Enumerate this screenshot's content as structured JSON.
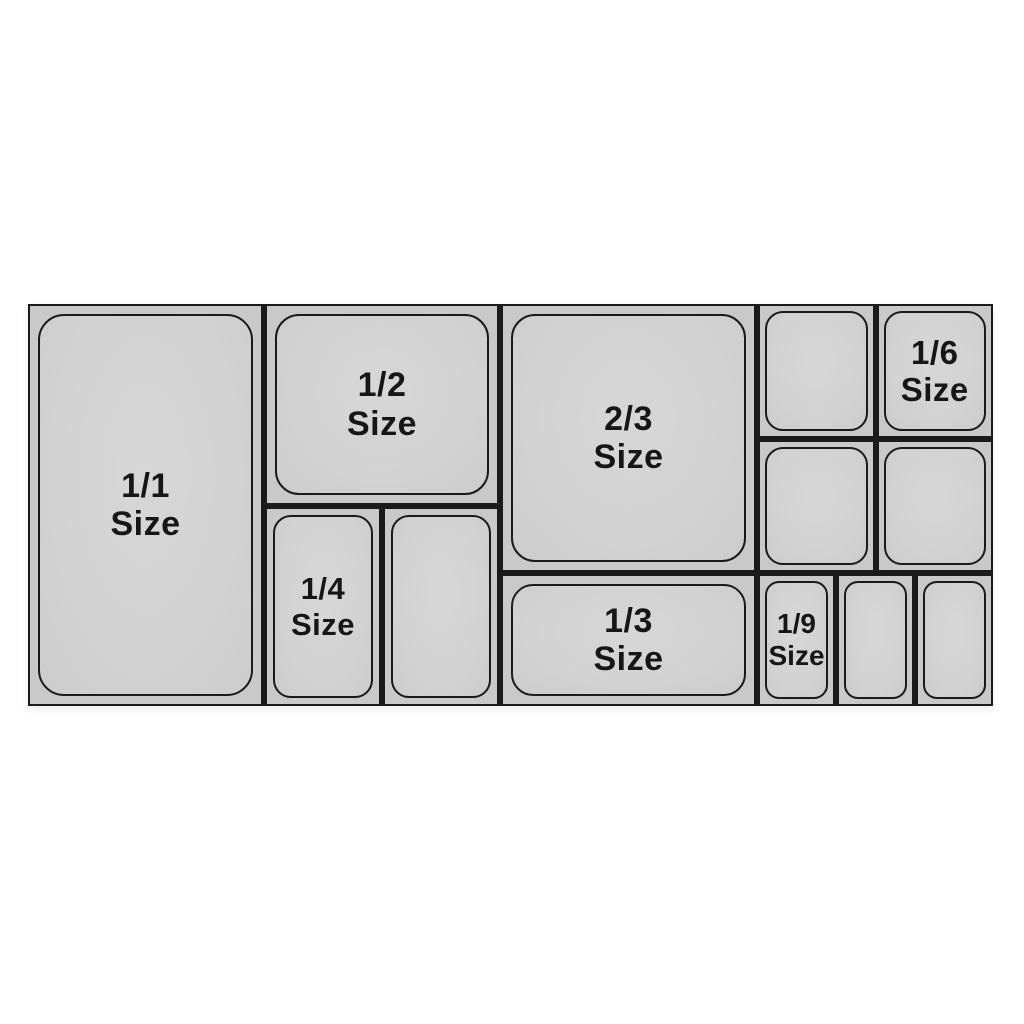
{
  "figure": {
    "colors": {
      "line": "#1a1a1a",
      "cell_fill": "#c9c9c9",
      "pan_fill": "#d2d2d2",
      "label_text": "#161616",
      "background": "#ffffff"
    },
    "labels": {
      "full": {
        "fraction": "1/1",
        "word": "Size"
      },
      "half": {
        "fraction": "1/2",
        "word": "Size"
      },
      "two_thirds": {
        "fraction": "2/3",
        "word": "Size"
      },
      "quarter": {
        "fraction": "1/4",
        "word": "Size"
      },
      "third": {
        "fraction": "1/3",
        "word": "Size"
      },
      "sixth": {
        "fraction": "1/6",
        "word": "Size"
      },
      "ninth": {
        "fraction": "1/9",
        "word": "Size"
      }
    },
    "pans": [
      {
        "size": "1/1",
        "labeled": true
      },
      {
        "size": "1/2",
        "labeled": true
      },
      {
        "size": "1/4",
        "labeled": true
      },
      {
        "size": "1/4",
        "labeled": false
      },
      {
        "size": "2/3",
        "labeled": true
      },
      {
        "size": "1/3",
        "labeled": true
      },
      {
        "size": "1/6",
        "labeled": false
      },
      {
        "size": "1/6",
        "labeled": true
      },
      {
        "size": "1/6",
        "labeled": false
      },
      {
        "size": "1/6",
        "labeled": false
      },
      {
        "size": "1/9",
        "labeled": true
      },
      {
        "size": "1/9",
        "labeled": false
      },
      {
        "size": "1/9",
        "labeled": false
      }
    ]
  }
}
